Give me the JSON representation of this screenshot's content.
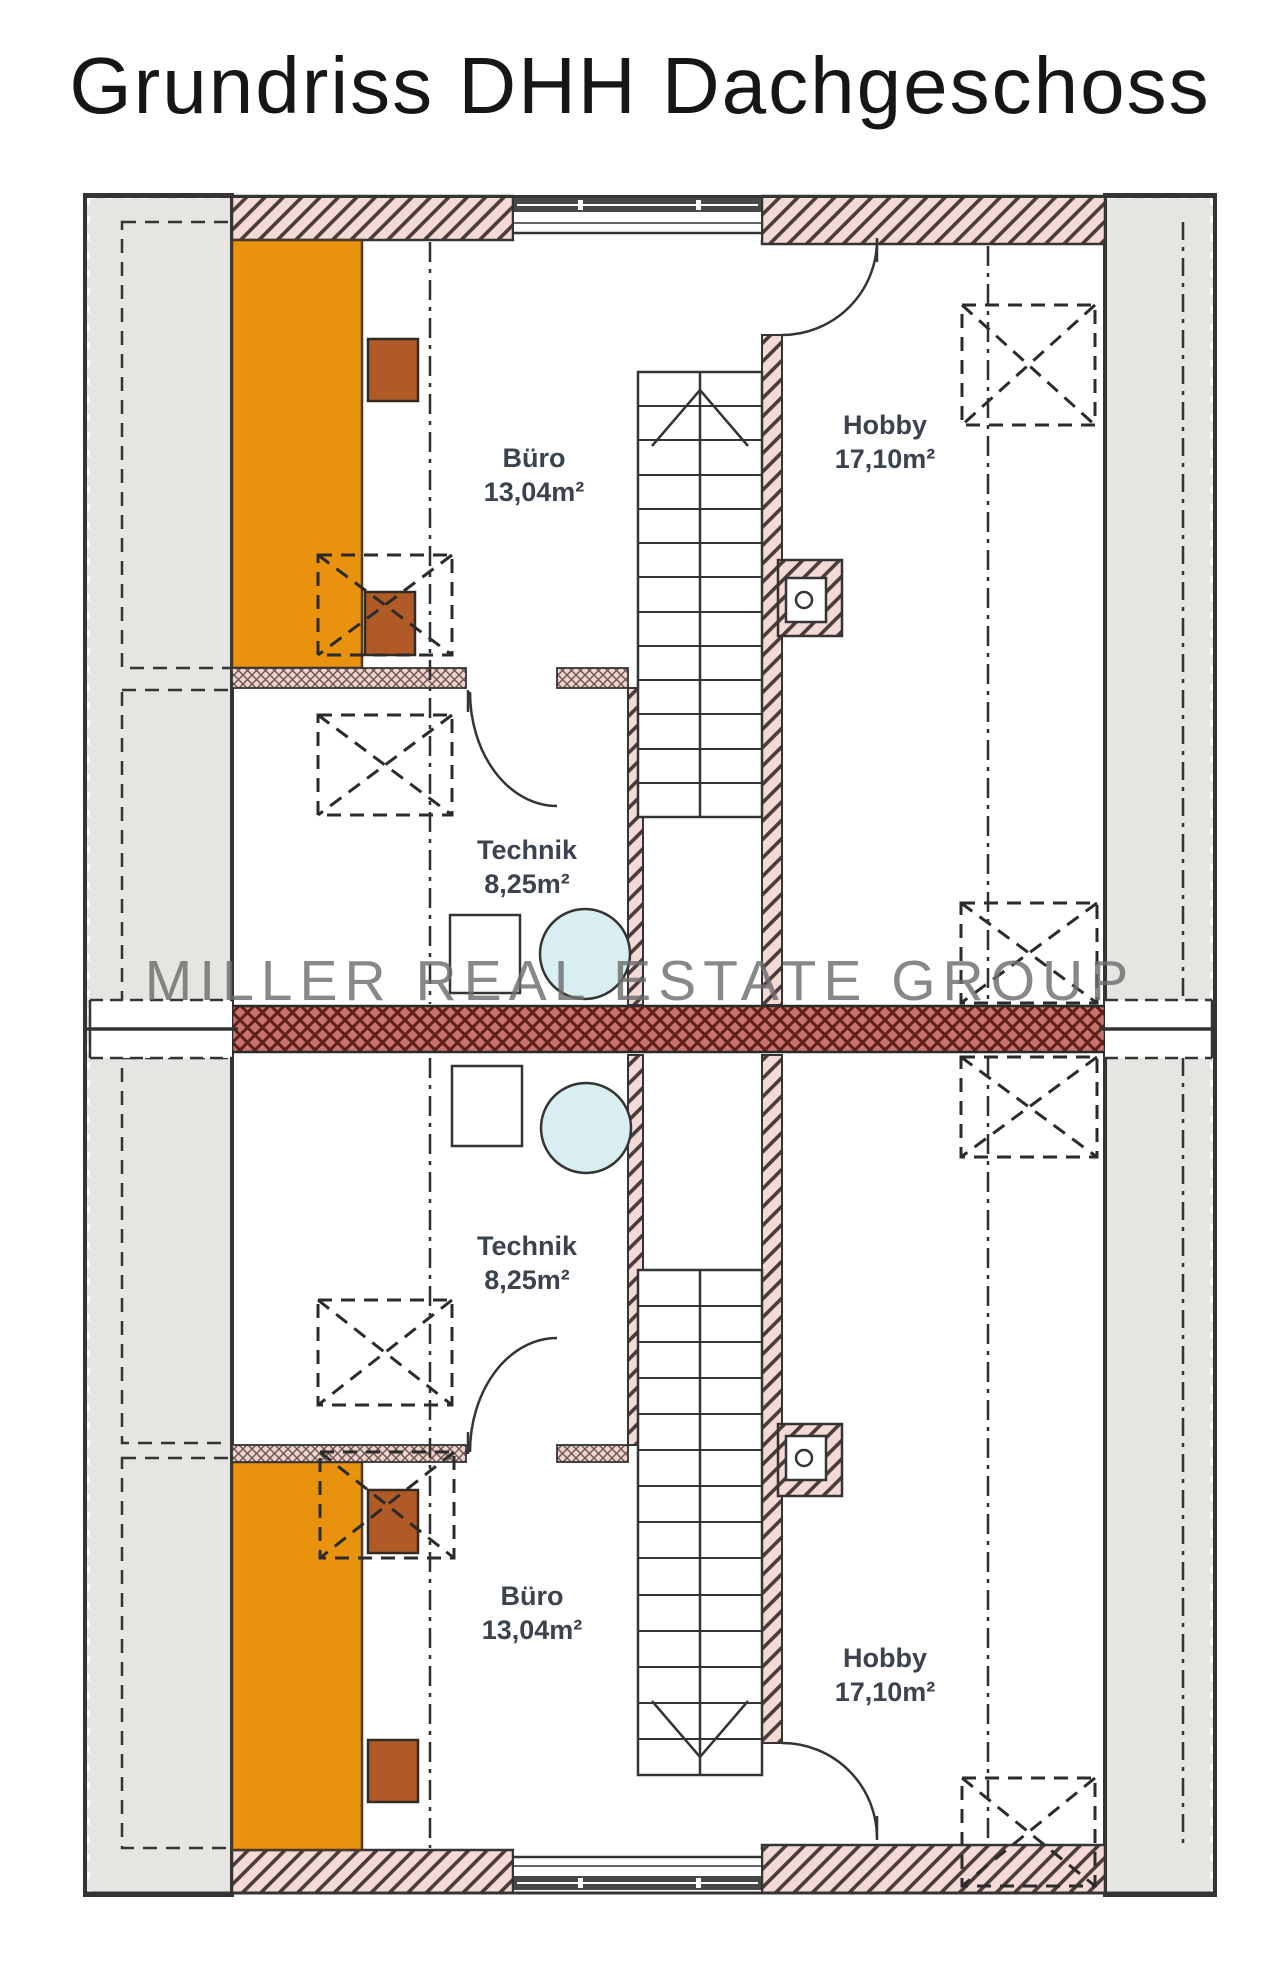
{
  "title": "Grundriss DHH Dachgeschoss",
  "watermark": "MILLER REAL ESTATE GROUP",
  "rooms": {
    "buero_upper": {
      "name": "Büro",
      "area": "13,04m²"
    },
    "technik_upper": {
      "name": "Technik",
      "area": "8,25m²"
    },
    "hobby_upper": {
      "name": "Hobby",
      "area": "17,10m²"
    },
    "technik_lower": {
      "name": "Technik",
      "area": "8,25m²"
    },
    "buero_lower": {
      "name": "Büro",
      "area": "13,04m²"
    },
    "hobby_lower": {
      "name": "Hobby",
      "area": "17,10m²"
    }
  },
  "colors": {
    "accent-orange": "#E8920E",
    "wall-pink": "#F4DAD6",
    "hatch-line": "#4A3C38",
    "party-red": "#C8736C",
    "party-line": "#5E201B",
    "water-blue": "#D9EEF0",
    "gray-band": "#E6E5E2",
    "line-dark": "#343434",
    "label-color": "#3A434E",
    "brown-box": "#B05A28",
    "watermark-gray": "#6E6E6E"
  }
}
